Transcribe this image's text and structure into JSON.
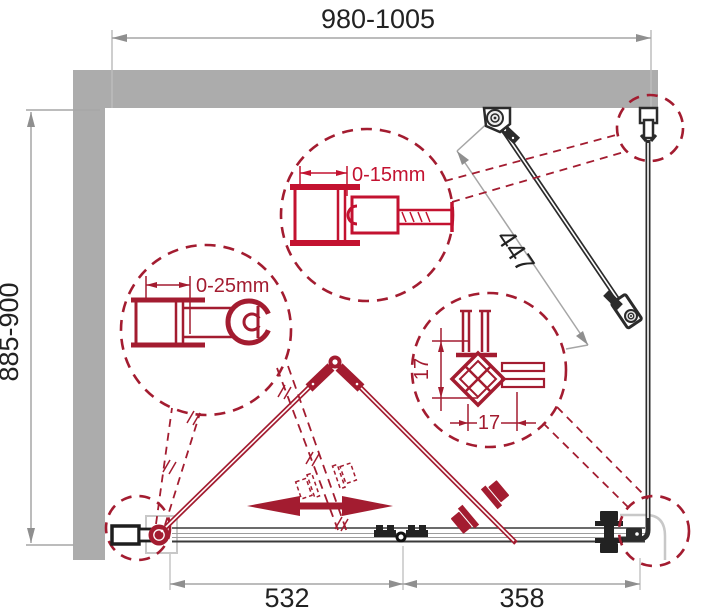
{
  "diagram": {
    "type": "shower-enclosure-folding-door-technical-drawing",
    "dimensions": {
      "top_width": "980-1005",
      "left_height": "885-900",
      "door_panel_diagonal": "447",
      "bottom_door_width": "532",
      "bottom_side_width": "358"
    },
    "details": {
      "wall_profile_top": "0-15mm",
      "wall_profile_left": "0-25mm",
      "corner_profile_vertical": "17",
      "corner_profile_horizontal": "17"
    },
    "colors": {
      "accent_red": "#A31C30",
      "bright_red": "#C31230",
      "wall_gray": "#ACACAC",
      "dim_line_gray": "#A6A6A6",
      "drawing_black": "#2B2B2B",
      "text_black": "#222222",
      "tray_gray": "#C8C8C8"
    }
  }
}
